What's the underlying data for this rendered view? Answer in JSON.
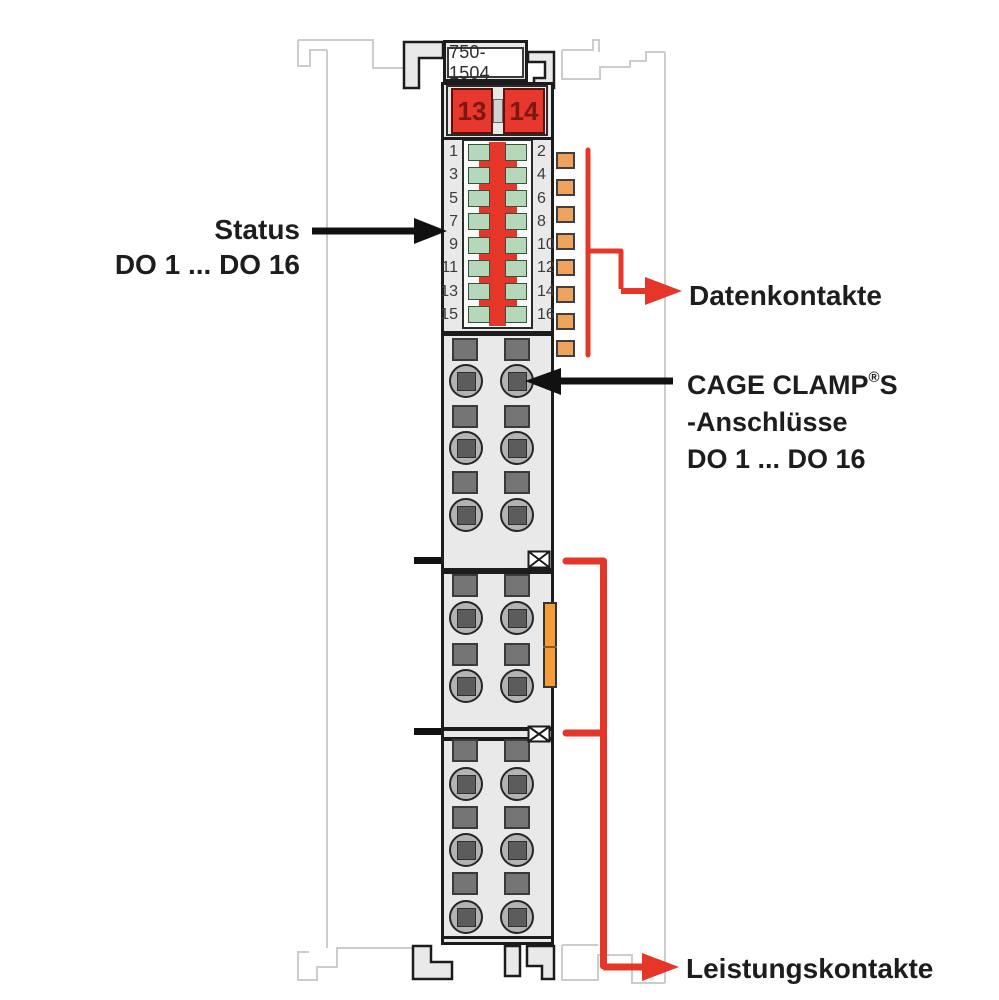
{
  "device": {
    "part_number": "750-1504",
    "jumper_buttons": [
      "13",
      "14"
    ]
  },
  "led_panel": {
    "left_numbers": [
      "1",
      "3",
      "5",
      "7",
      "9",
      "11",
      "13",
      "15"
    ],
    "right_numbers": [
      "2",
      "4",
      "6",
      "8",
      "10",
      "12",
      "14",
      "16"
    ]
  },
  "annotations": {
    "status_title": "Status",
    "status_range": "DO 1 ... DO 16",
    "data_contacts": "Datenkontakte",
    "cage_clamp_brand": "CAGE CLAMP",
    "cage_clamp_reg": "®",
    "cage_clamp_suffix": "S",
    "cage_clamp_line2": "-Anschlüsse",
    "cage_clamp_line3": "DO 1 ... DO 16",
    "power_contacts": "Leistungskontakte"
  },
  "colors": {
    "accent-red": "#e63529",
    "button-red": "#e8372c",
    "button-text": "#7c1812",
    "led-green": "#b5d8bb",
    "contact-orange": "#efa25b",
    "latch-orange": "#f49d38",
    "module-fill": "#e9e9e9",
    "outline-dark": "#1c1c1c",
    "neighbor-outline": "#cccccc",
    "label-text": "#1d1d1d"
  }
}
